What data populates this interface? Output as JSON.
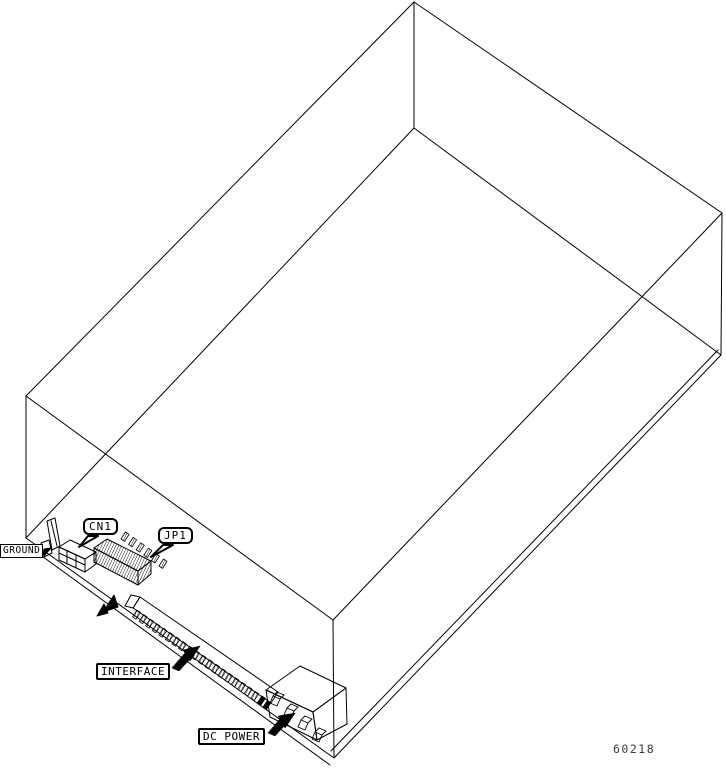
{
  "diagram": {
    "description": "Isometric wireframe line drawing of a disk drive chassis showing connector locations",
    "callouts": {
      "ground": "GROUND",
      "cn1": "CN1",
      "jp1": "JP1",
      "interface": "INTERFACE",
      "dc_power": "DC POWER"
    },
    "figure_number": "60218",
    "colors": {
      "line": "#000000",
      "background": "#ffffff",
      "figure_number_text": "#3b3b3b"
    }
  }
}
